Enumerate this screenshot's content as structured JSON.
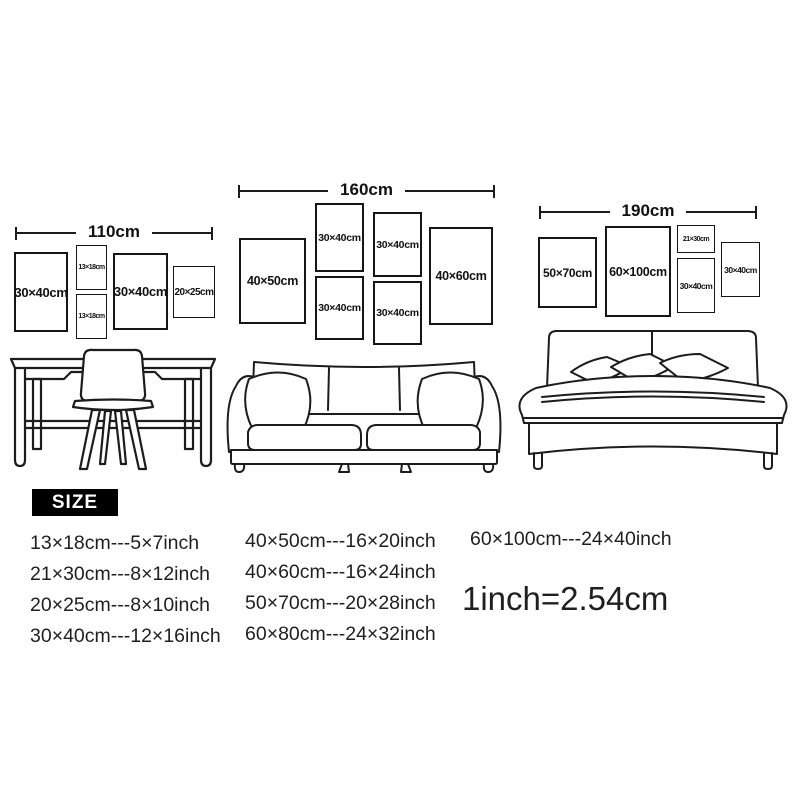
{
  "scenes": [
    {
      "name": "desk",
      "dimension_label": "110cm",
      "frames": [
        {
          "label": "30×40cm"
        },
        {
          "label": "13×18cm"
        },
        {
          "label": "13×18cm"
        },
        {
          "label": "30×40cm"
        },
        {
          "label": "20×25cm"
        }
      ]
    },
    {
      "name": "sofa",
      "dimension_label": "160cm",
      "frames": [
        {
          "label": "40×50cm"
        },
        {
          "label": "30×40cm"
        },
        {
          "label": "30×40cm"
        },
        {
          "label": "30×40cm"
        },
        {
          "label": "30×40cm"
        },
        {
          "label": "40×60cm"
        }
      ]
    },
    {
      "name": "bed",
      "dimension_label": "190cm",
      "frames": [
        {
          "label": "50×70cm"
        },
        {
          "label": "60×100cm"
        },
        {
          "label": "21×30cm"
        },
        {
          "label": "30×40cm"
        },
        {
          "label": "30×40cm"
        }
      ]
    }
  ],
  "size_chart": {
    "title": "SIZE",
    "columns": [
      [
        "13×18cm---5×7inch",
        "21×30cm---8×12inch",
        "20×25cm---8×10inch",
        "30×40cm---12×16inch"
      ],
      [
        "40×50cm---16×20inch",
        "40×60cm---16×24inch",
        "50×70cm---20×28inch",
        "60×80cm---24×32inch"
      ],
      [
        "60×100cm---24×40inch"
      ]
    ],
    "conversion": "1inch=2.54cm"
  },
  "colors": {
    "ink": "#1c1c1c",
    "background": "#ffffff",
    "badge_bg": "#000000",
    "badge_text": "#ffffff"
  }
}
